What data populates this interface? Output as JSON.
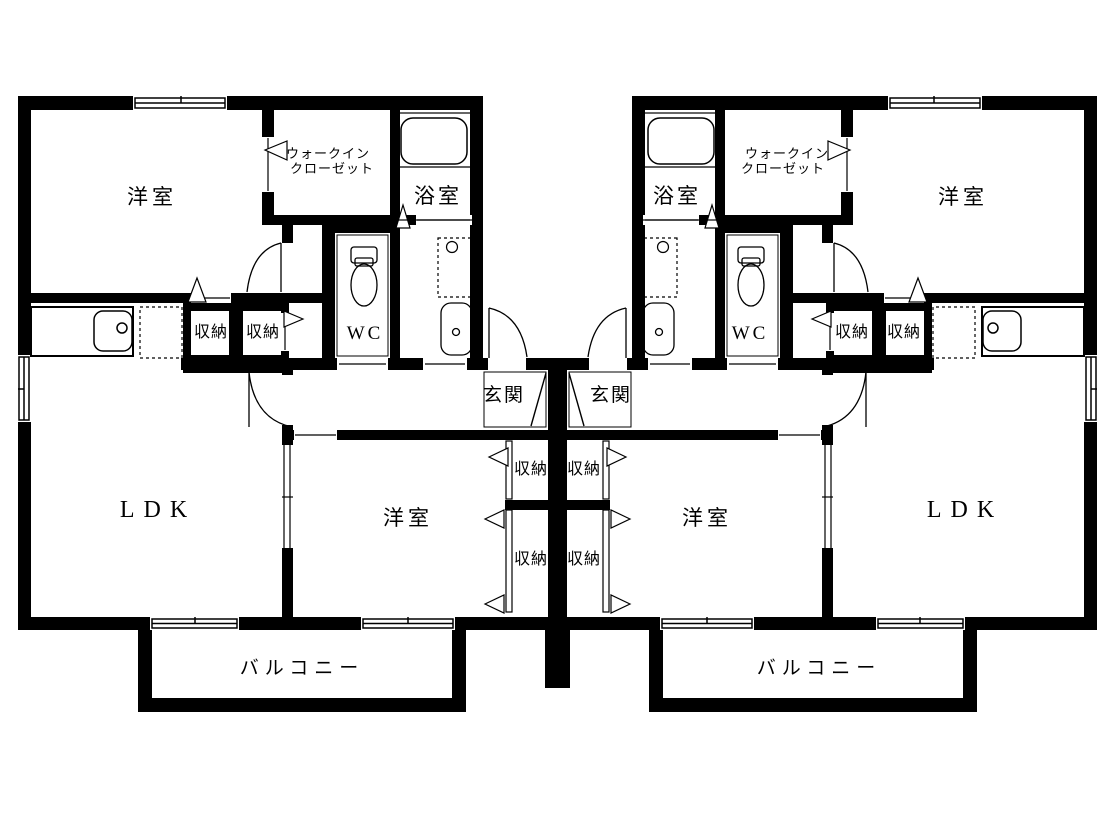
{
  "diagram": {
    "type": "apartment-floor-plan",
    "units": 2,
    "layout": "mirrored left/right units"
  },
  "room_labels": {
    "bedroom": "洋室",
    "walk_in_closet_line1": "ウォークイン",
    "walk_in_closet_line2": "クローゼット",
    "bath": "浴室",
    "toilet": "WC",
    "storage": "収納",
    "entrance": "玄関",
    "living_dining_kitchen": "LDK",
    "balcony": "バルコニー"
  },
  "colors": {
    "wall": "#000000",
    "background": "#ffffff",
    "line": "#000000"
  }
}
